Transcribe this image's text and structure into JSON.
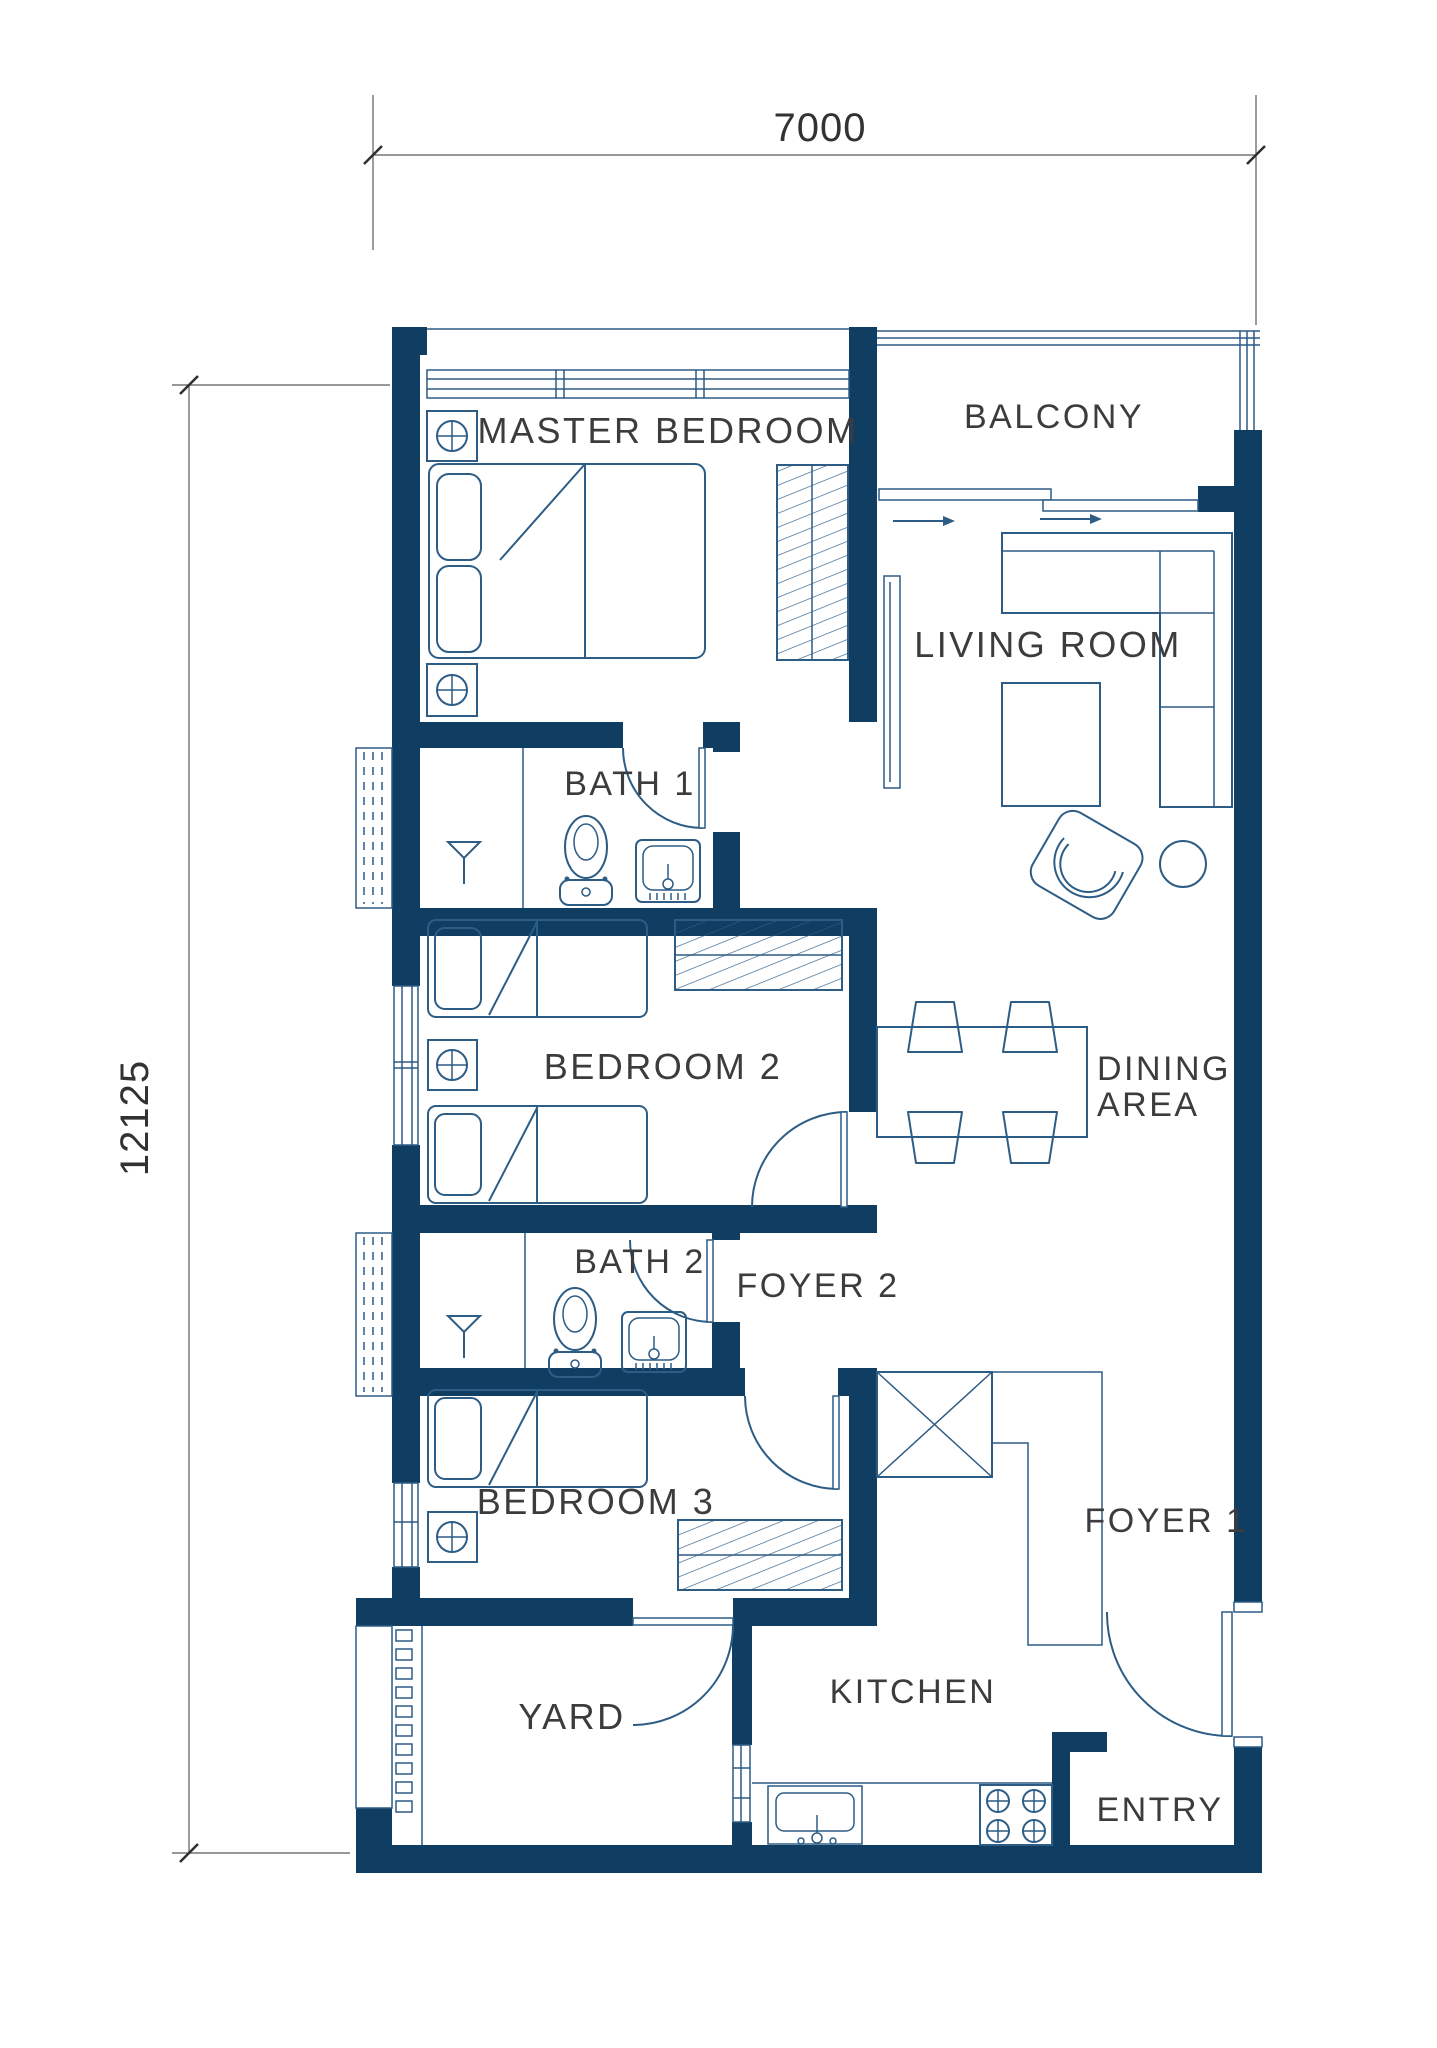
{
  "plan_title": "3-bedroom unit floor plan",
  "dimensions": {
    "top": "7000",
    "left": "12125"
  },
  "rooms": {
    "master_bedroom": "MASTER BEDROOM",
    "balcony": "BALCONY",
    "living_room": "LIVING ROOM",
    "bath_1": "BATH 1",
    "bedroom_2": "BEDROOM 2",
    "dining_line1": "DINING",
    "dining_line2": "AREA",
    "bath_2": "BATH 2",
    "foyer_2": "FOYER 2",
    "bedroom_3": "BEDROOM 3",
    "foyer_1": "FOYER 1",
    "yard": "YARD",
    "kitchen": "KITCHEN",
    "entry": "ENTRY"
  },
  "furniture_icons": {
    "double-bed-icon": "double bed with two pillows",
    "single-bed-icon": "single bed with pillow",
    "nightstand-lamp-icon": "bedside table with lamp (circle-cross)",
    "wardrobe-icon": "hatched wardrobe cabinet",
    "sofa-icon": "L-shaped sofa",
    "coffee-table-icon": "rectangular coffee table",
    "armchair-icon": "rotated armchair",
    "side-table-icon": "round side table",
    "tv-console-icon": "wall TV console",
    "dining-table-icon": "dining table",
    "dining-chair-icon": "dining chair",
    "toilet-icon": "toilet with tank",
    "basin-icon": "wash basin with faucet",
    "shower-icon": "shower drain symbol",
    "kitchen-sink-icon": "kitchen sink",
    "stove-icon": "4-burner stove",
    "kitchen-counter-icon": "L-shaped kitchen counter",
    "utility-box-icon": "crossed utility box",
    "door-swing-icon": "door leaf with quarter-circle swing",
    "sliding-door-icon": "sliding door track with arrow",
    "window-icon": "framed window",
    "railing-icon": "balcony railing lines",
    "ac-ledge-icon": "ledge with dashed louvers",
    "louver-icon": "louvered vent squares"
  },
  "colors": {
    "wall": "#103e63",
    "line": "#2d5c85",
    "line_light": "#7f9cb3",
    "text": "#3c3c3e",
    "dim": "#5a5a5c"
  }
}
